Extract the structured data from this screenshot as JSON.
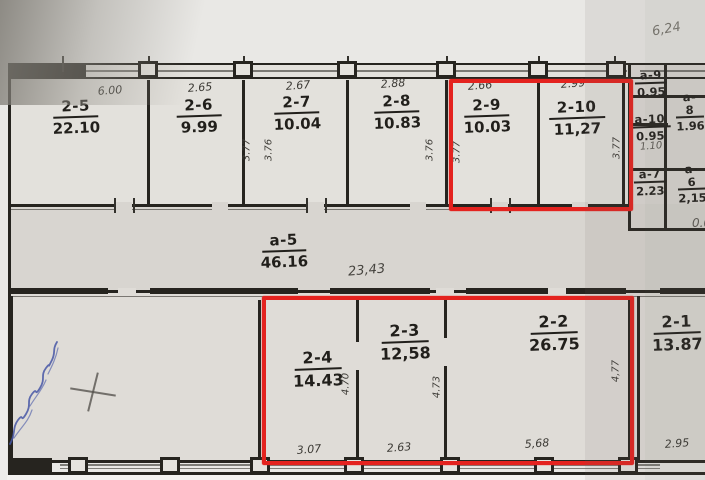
{
  "colors": {
    "highlight_red": "#e4231f",
    "ink": "#26241f",
    "pencil_gray": "#6e6b65",
    "blue_ink": "#4656a6",
    "paper": "#dbd8d3"
  },
  "top_rooms": [
    {
      "id": "2-5",
      "area": "22.10",
      "width": "6.00"
    },
    {
      "id": "2-6",
      "area": "9.99",
      "width": "2.65"
    },
    {
      "id": "2-7",
      "area": "10.04",
      "width": "2.67"
    },
    {
      "id": "2-8",
      "area": "10.83",
      "width": "2.88"
    },
    {
      "id": "2-9",
      "area": "10.03",
      "width": "2.66"
    },
    {
      "id": "2-10",
      "area": "11,27",
      "width": "2.99"
    }
  ],
  "top_vertical_dims": [
    "3.77",
    "3.76",
    "3.76",
    "3.77",
    "3.77"
  ],
  "side_rooms": [
    {
      "id": "a-9",
      "area": "0.95"
    },
    {
      "id": "a-8",
      "area": "1.96"
    },
    {
      "id": "a-10",
      "area": "0.95"
    },
    {
      "id": "a-7",
      "area": "2.23"
    },
    {
      "id": "a-6",
      "area": "2,15"
    }
  ],
  "side_notes": {
    "handwritten_dim": "1.10",
    "partial_number": "0.0"
  },
  "corridor": {
    "id": "a-5",
    "area": "46.16",
    "handwritten_dim": "23,43"
  },
  "bottom_rooms": [
    {
      "id": "2-4",
      "area": "14.43",
      "bottom_width": "3.07",
      "height": "4.70"
    },
    {
      "id": "2-3",
      "area": "12,58",
      "bottom_width": "2.63",
      "height": "4.73"
    },
    {
      "id": "2-2",
      "area": "26.75",
      "bottom_width": "5,68",
      "height": "4,77"
    },
    {
      "id": "2-1",
      "area": "13.87",
      "bottom_width": "2.95"
    }
  ],
  "highlights": [
    {
      "rooms": "2-9, 2-10"
    },
    {
      "rooms": "2-4, 2-3, 2-2"
    }
  ],
  "margin_notes": {
    "top_right": "6,24"
  }
}
